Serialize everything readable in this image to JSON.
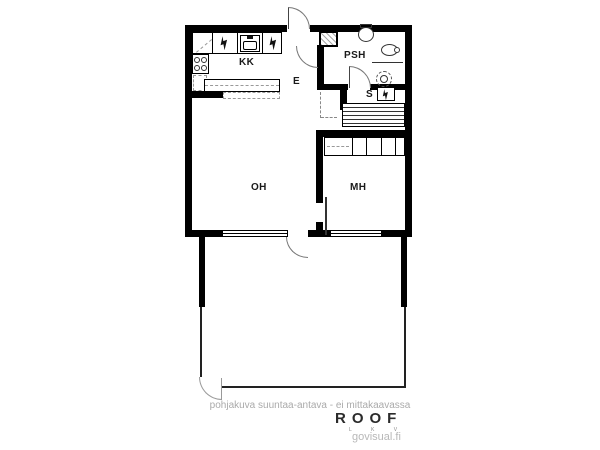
{
  "plan": {
    "rooms": [
      {
        "id": "kk",
        "label": "KK"
      },
      {
        "id": "e",
        "label": "E"
      },
      {
        "id": "psh",
        "label": "PSH"
      },
      {
        "id": "s",
        "label": "S"
      },
      {
        "id": "oh",
        "label": "OH"
      },
      {
        "id": "mh",
        "label": "MH"
      }
    ],
    "symbols": [
      "electric-appliance-lightning",
      "kitchen-sink",
      "stove-burners",
      "toilet",
      "washbasin",
      "shower-drain",
      "sauna-heater",
      "sauna-benches",
      "wardrobe-row",
      "duct-shaft",
      "window",
      "door-swing",
      "sliding-door"
    ],
    "colors": {
      "wall": "#000000",
      "door_arc": "#777777",
      "dashed": "#999999",
      "label": "#1a1a1a",
      "background": "#ffffff"
    }
  },
  "footer": {
    "disclaimer": "pohjakuva suuntaa-antava - ei mittakaavassa",
    "brand": "ROOF",
    "brand_sub": "L K V",
    "site": "govisual.fi"
  }
}
